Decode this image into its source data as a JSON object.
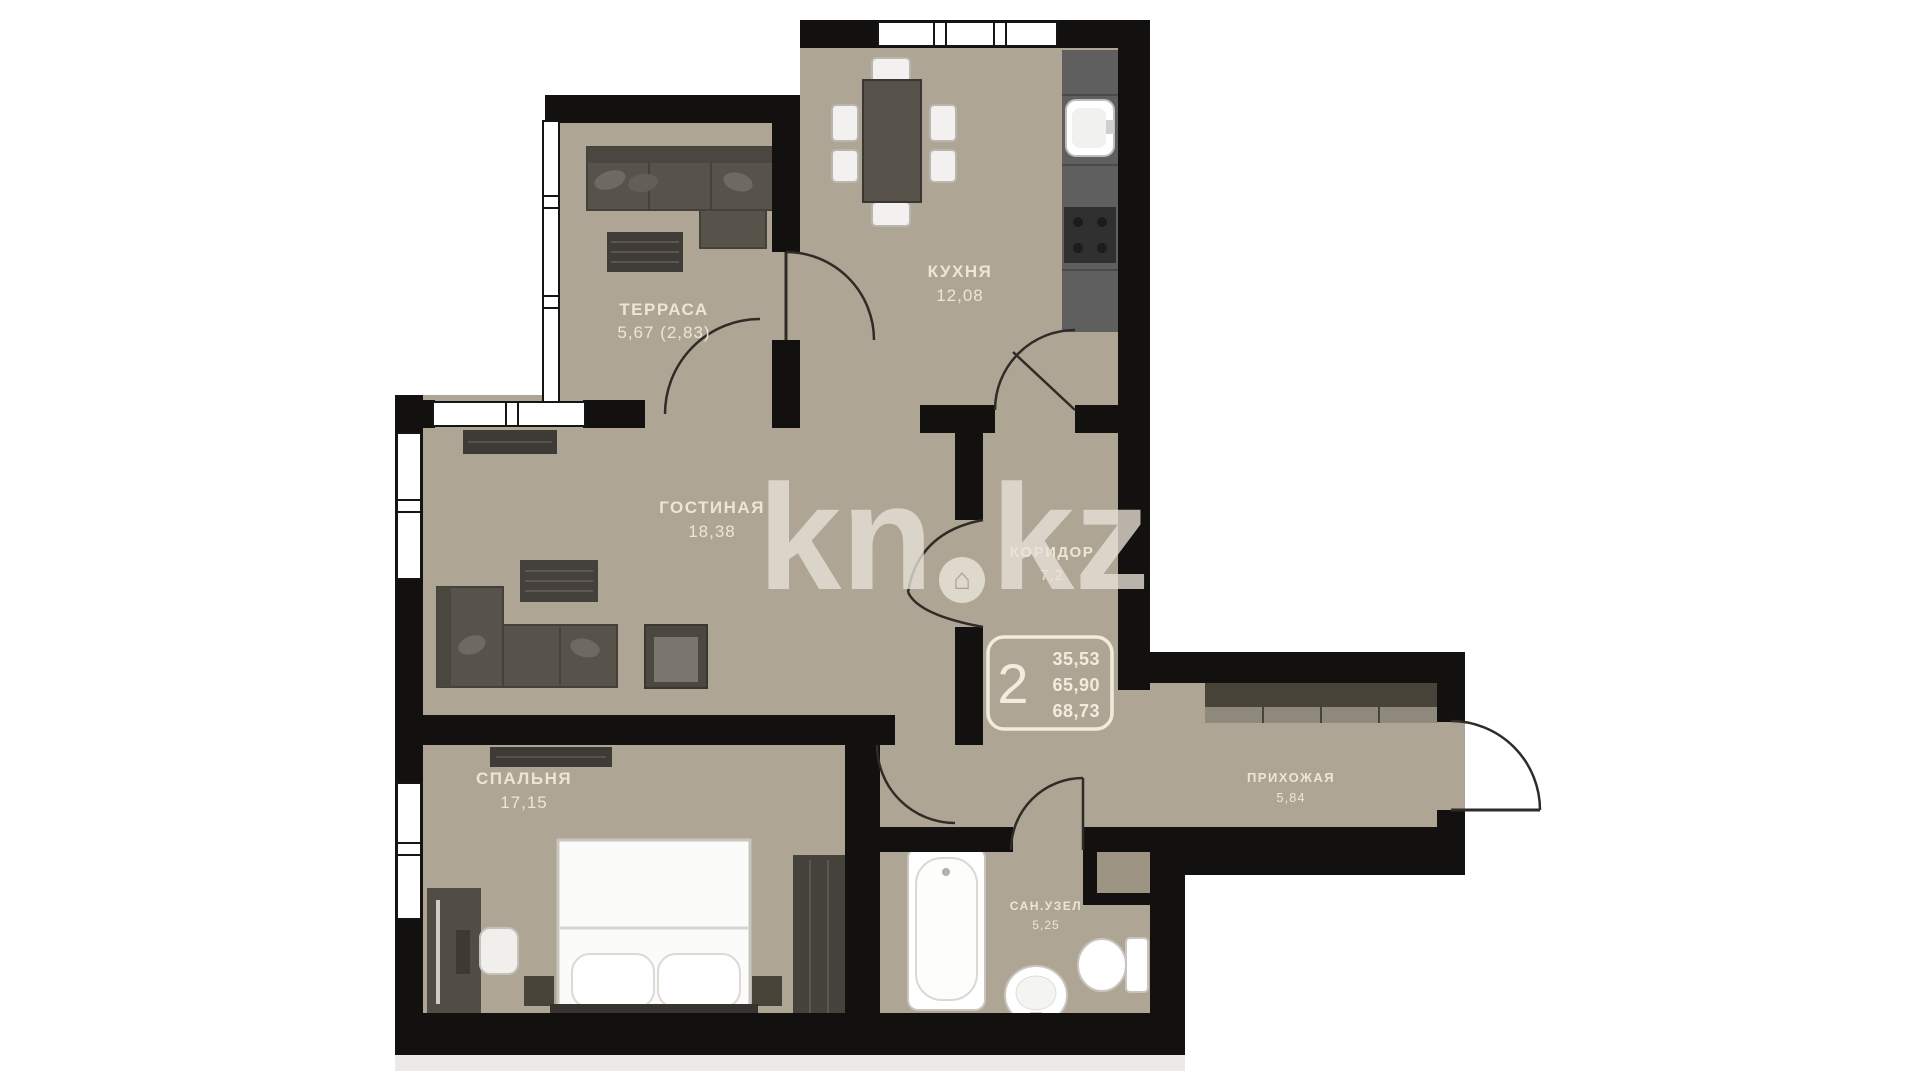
{
  "plan": {
    "watermark": {
      "left": "kn",
      "right": "kz",
      "dot_icon": "house-in-circle"
    },
    "rooms": [
      {
        "id": "terrace",
        "name": "ТЕРРАСА",
        "area": "5,67 (2,83)"
      },
      {
        "id": "kitchen",
        "name": "КУХНЯ",
        "area": "12,08"
      },
      {
        "id": "living",
        "name": "ГОСТИНАЯ",
        "area": "18,38"
      },
      {
        "id": "corridor",
        "name": "КОРИДОР",
        "area": "7,2"
      },
      {
        "id": "bedroom",
        "name": "СПАЛЬНЯ",
        "area": "17,15"
      },
      {
        "id": "hallway",
        "name": "ПРИХОЖАЯ",
        "area": "5,84"
      },
      {
        "id": "bathroom",
        "name": "САН.УЗЕЛ",
        "area": "5,25"
      }
    ],
    "info_box": {
      "rooms_count": "2",
      "values": [
        "35,53",
        "65,90",
        "68,73"
      ]
    },
    "colors": {
      "floor": "#AFA595",
      "wall": "#12110F",
      "furniture_dark": "#55514A",
      "fixture_white": "#FFFFFF",
      "label_text": "#F1EAD9",
      "watermark": "#E8E2D6"
    }
  }
}
